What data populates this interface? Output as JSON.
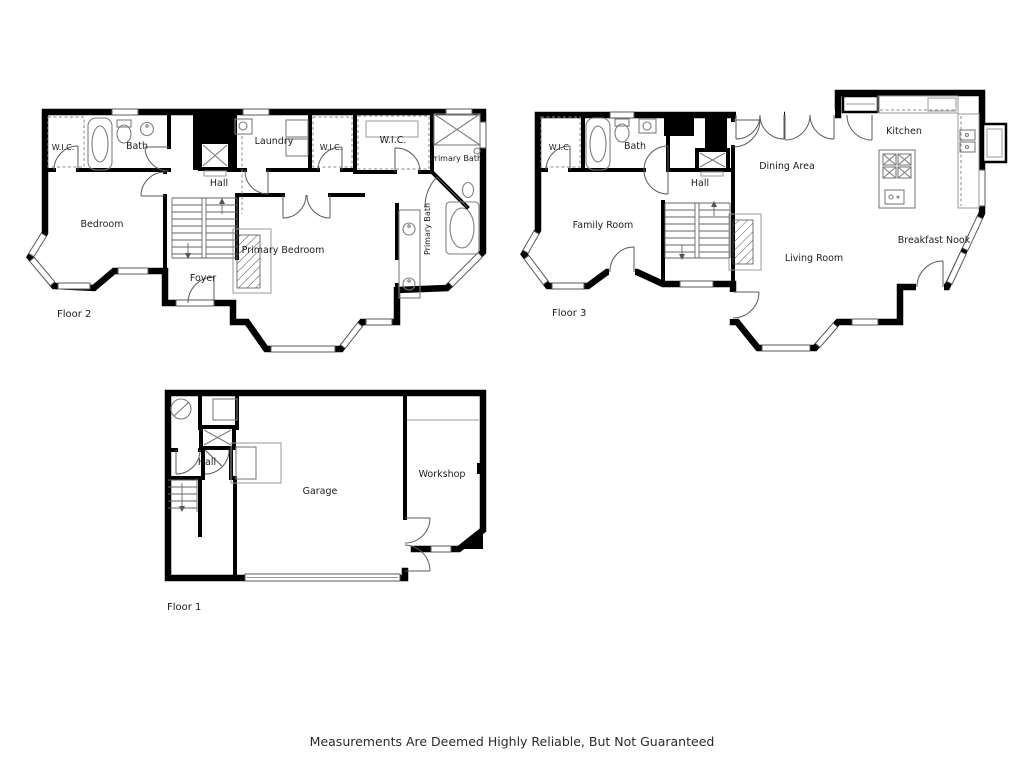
{
  "canvas": {
    "width": 1024,
    "height": 768,
    "background_color": "#ffffff",
    "wall_color": "#000000",
    "fixture_color": "#7d7d7d",
    "door_color": "#5a5a5a",
    "label_color": "#1c1c1c"
  },
  "disclaimer": "Measurements Are Deemed Highly Reliable, But Not Guaranteed",
  "floor2": {
    "label": "Floor 2",
    "rooms": {
      "wic": "W.I.C.",
      "bath": "Bath",
      "hall": "Hall",
      "laundry": "Laundry",
      "wic2": "W.I.C.",
      "wic3": "W.I.C.",
      "primary_bath_top": "Primary Bath",
      "primary_bath_side": "Primary Bath",
      "bedroom": "Bedroom",
      "primary_bedroom": "Primary Bedroom",
      "foyer": "Foyer"
    }
  },
  "floor3": {
    "label": "Floor 3",
    "rooms": {
      "wic": "W.I.C.",
      "bath": "Bath",
      "hall": "Hall",
      "family_room": "Family Room",
      "dining_area": "Dining Area",
      "kitchen": "Kitchen",
      "breakfast_nook": "Breakfast Nook",
      "living_room": "Living Room"
    }
  },
  "floor1": {
    "label": "Floor 1",
    "rooms": {
      "hall": "Hall",
      "garage": "Garage",
      "workshop": "Workshop"
    }
  }
}
